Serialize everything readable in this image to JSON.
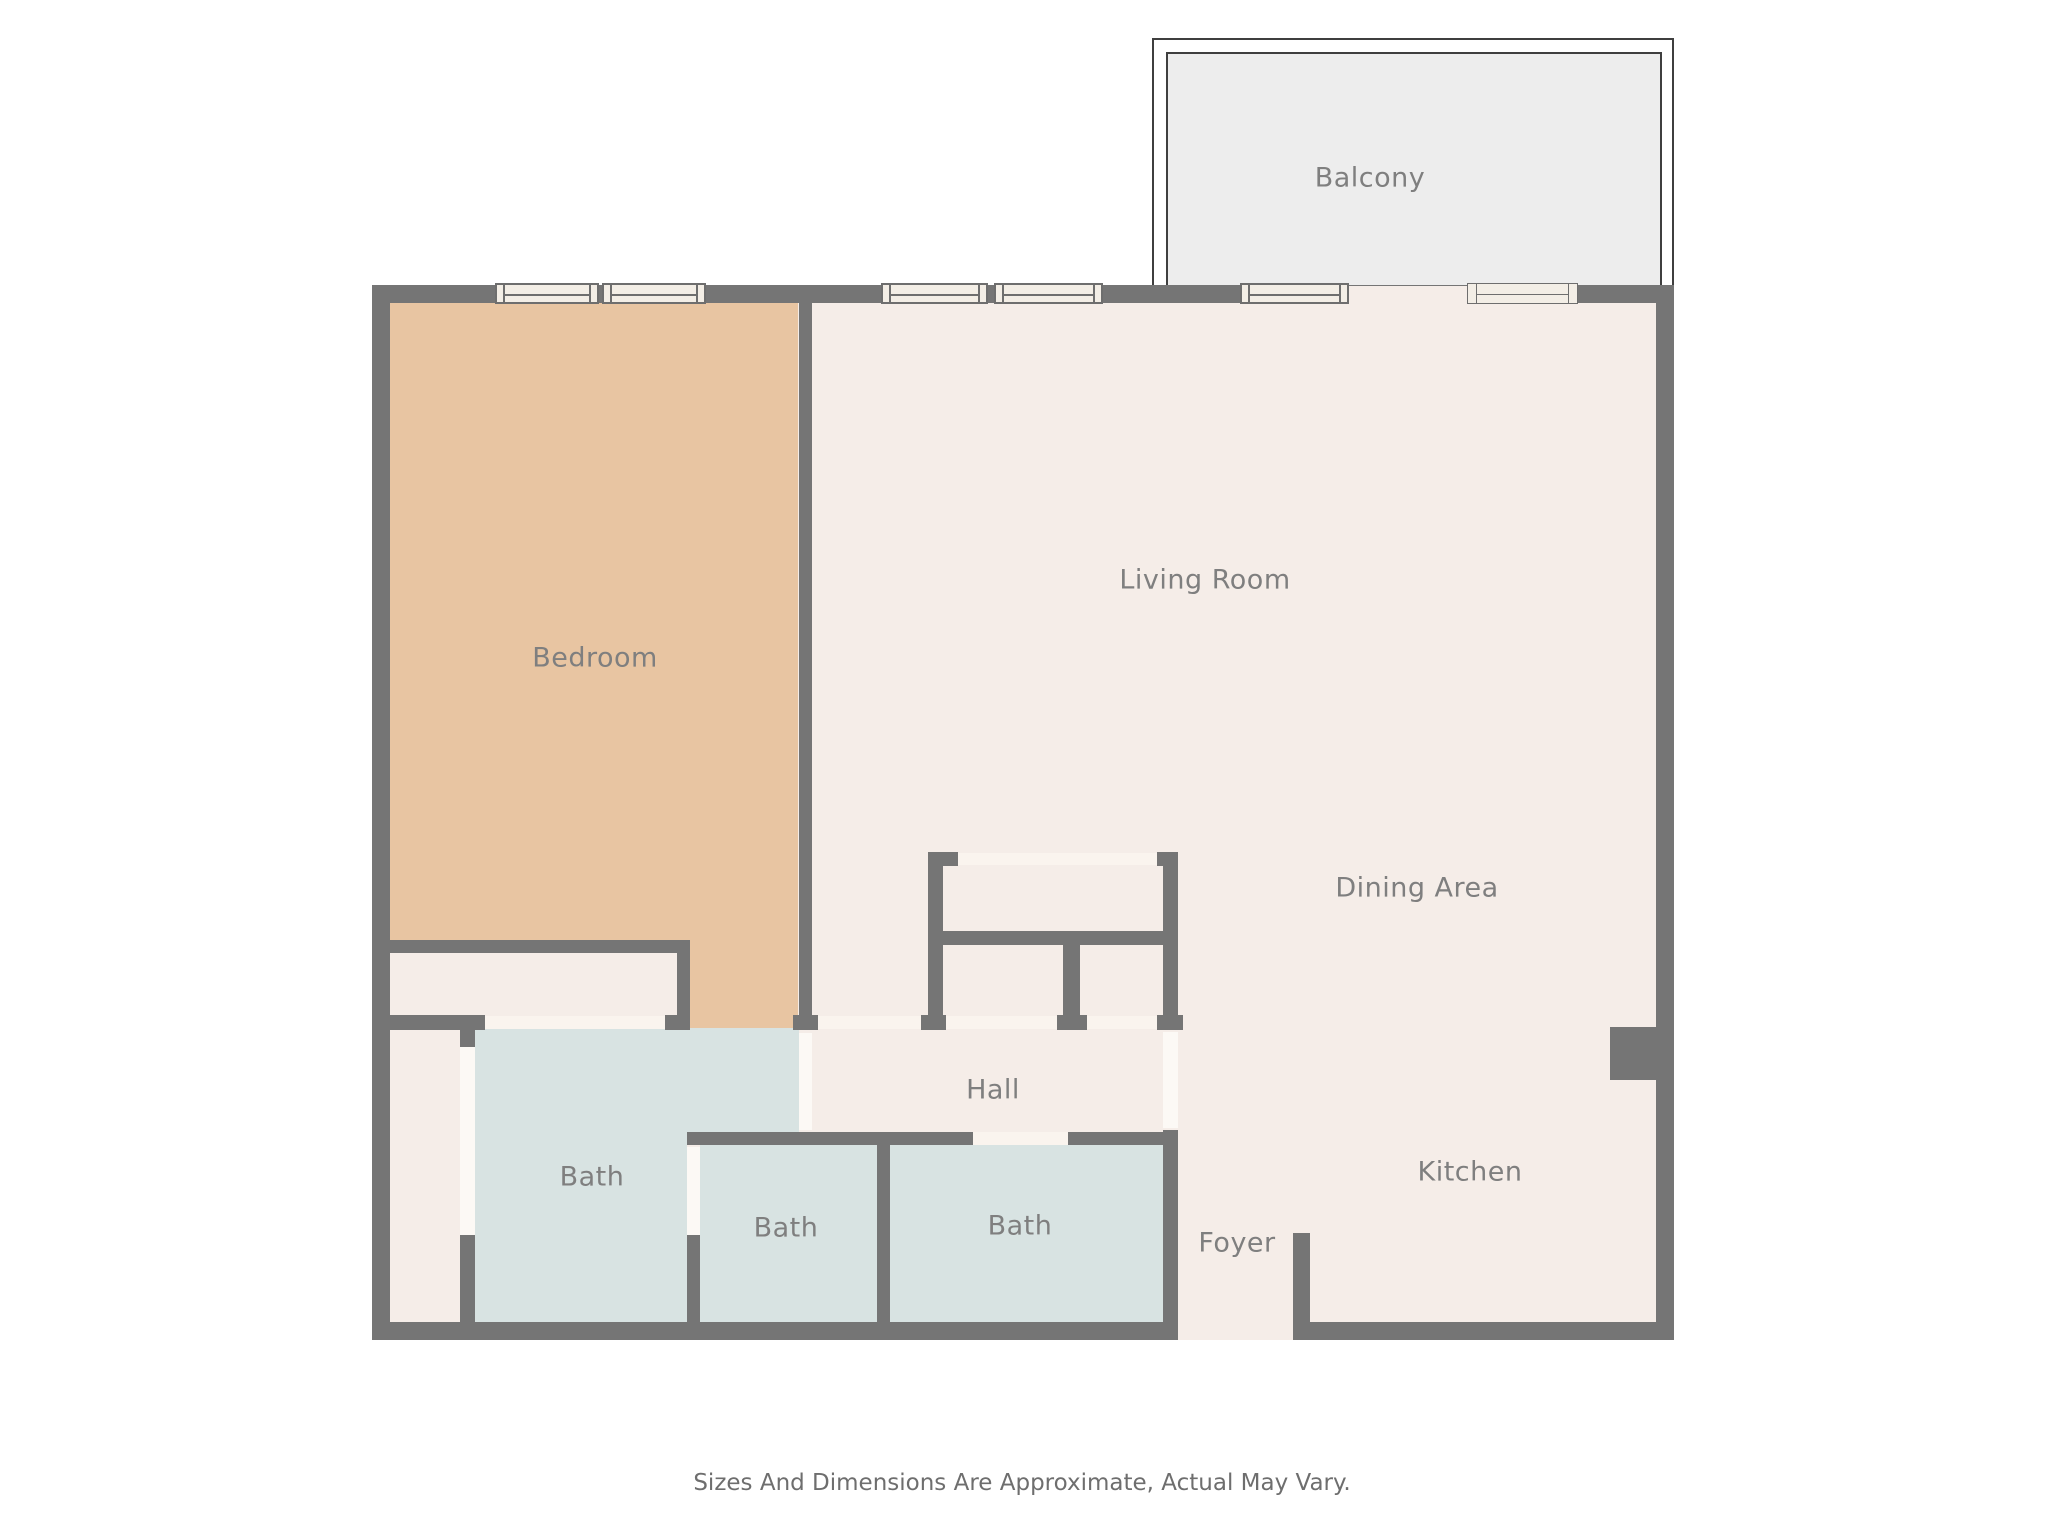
{
  "title": "Floor plan",
  "colors": {
    "wall": "#757575",
    "floor": "#f5ede8",
    "bedroom": "#e8c5a2",
    "bath": "#d8e3e2",
    "balcony": "#ededed",
    "windowFill": "#f3eee6",
    "openingLight": "#faf4ee",
    "doorWhite": "#fcf9f5",
    "outline": "#3f3f3f",
    "text": "#7f7f7f"
  },
  "rooms": [
    {
      "id": "balcony",
      "label": "Balcony",
      "cx": 1370,
      "cy": 178
    },
    {
      "id": "bedroom",
      "label": "Bedroom",
      "cx": 595,
      "cy": 658
    },
    {
      "id": "living-room",
      "label": "Living Room",
      "cx": 1205,
      "cy": 580
    },
    {
      "id": "dining-area",
      "label": "Dining Area",
      "cx": 1417,
      "cy": 888
    },
    {
      "id": "hall",
      "label": "Hall",
      "cx": 993,
      "cy": 1090
    },
    {
      "id": "bath-1",
      "label": "Bath",
      "cx": 592,
      "cy": 1177
    },
    {
      "id": "bath-2",
      "label": "Bath",
      "cx": 786,
      "cy": 1228
    },
    {
      "id": "bath-3",
      "label": "Bath",
      "cx": 1020,
      "cy": 1226
    },
    {
      "id": "foyer",
      "label": "Foyer",
      "cx": 1237,
      "cy": 1243
    },
    {
      "id": "kitchen",
      "label": "Kitchen",
      "cx": 1470,
      "cy": 1172
    }
  ],
  "footer": {
    "text": "Sizes And Dimensions Are Approximate, Actual May Vary."
  }
}
